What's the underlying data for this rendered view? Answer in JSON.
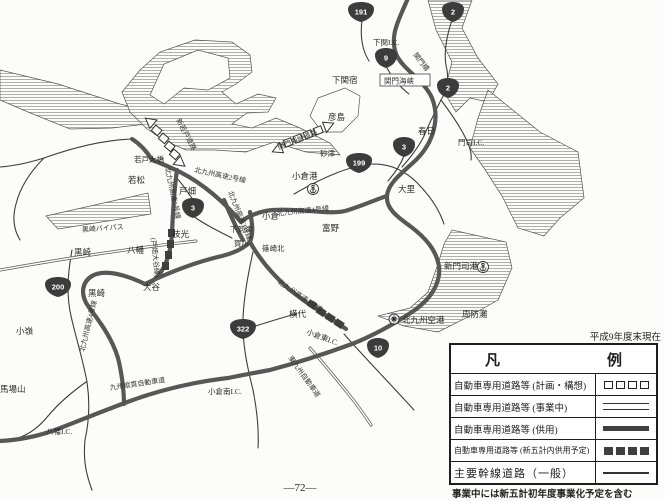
{
  "map": {
    "labels": {
      "shimonoseki_ic": "下関I.C.",
      "shimonoseki_shuku": "下関宿",
      "hikoshima": "彦島",
      "kanmon_bridge": "関門橋",
      "kanmon_kaikyo": "関門海峡",
      "kasuga": "春日",
      "moji_ic": "門司I.C.",
      "sunatsu": "砂津",
      "kanmonkaikyo_doro": "関門海峡道路",
      "kokura_port": "小倉港",
      "dairi": "大里",
      "shinwakato": "新若戸道路",
      "wakato_ohashi": "若戸大橋",
      "wakamatsu": "若松",
      "kosoku2": "北九州高速2号線",
      "tobata": "戸畑",
      "kosoku3": "北九州高速3号線",
      "edamitsu": "枝光",
      "kosoku5": "北九州高速5号線",
      "otani_sen": "(戸畑大谷線)",
      "yahata": "八幡",
      "otani": "大谷",
      "kurosaki_bp": "黒崎バイパス",
      "kurosaki1": "黒崎",
      "kurosaki2": "黒崎",
      "kosoku4w": "北九州高速4号線",
      "komine": "小嶺",
      "babayama": "馬場山",
      "yahata_ic": "八幡I.C.",
      "kyushu_judan": "九州縦貫自動車道",
      "kokuraminami_ic": "小倉南I.C.",
      "shimoitozu": "下到津",
      "kagawa": "賀川",
      "shinozakikita": "篠崎北",
      "kokura": "小倉",
      "kosoku4e": "北九州高速4号線",
      "tomino": "富野",
      "kosoku1": "北九州高速1号線",
      "yokoshiro": "横代",
      "kokurahigashi_ic": "小倉東I.C.",
      "higashikyushu": "東九州自動車道",
      "shinmoji_port": "新門司港",
      "suonada": "周防灘",
      "kk_airport": "北九州空港"
    },
    "shields": {
      "r191": "191",
      "r2a": "2",
      "r9": "9",
      "r2b": "2",
      "r3a": "3",
      "r199": "199",
      "r3b": "3",
      "r200": "200",
      "r322": "322",
      "r10": "10"
    },
    "icons": {
      "anchor_kokura": "anchor-icon",
      "anchor_shinmoji": "anchor-icon",
      "airport": "airport-icon"
    }
  },
  "legend": {
    "title_left": "凡",
    "title_right": "例",
    "rows": [
      {
        "label": "自動車専用道路等 (計画・構想)",
        "symbol": "open-squares"
      },
      {
        "label": "自動車専用道路等 (事業中)",
        "symbol": "double-line"
      },
      {
        "label": "自動車専用道路等 (供用)",
        "symbol": "thick-line"
      },
      {
        "label": "自動車専用道路等 (新五計内供用予定)",
        "symbol": "filled-squares"
      },
      {
        "label": "主要幹線道路（一般）",
        "symbol": "thin-line"
      }
    ],
    "date_note": "平成9年度末現在",
    "note": "事業中には新五計初年度事業化予定を含む"
  },
  "page_number": "―72―",
  "colors": {
    "road_open": "#575757",
    "shield_fill": "#3c3c3c",
    "ink": "#2a2a2a",
    "hatch": "#9a9a9a"
  }
}
